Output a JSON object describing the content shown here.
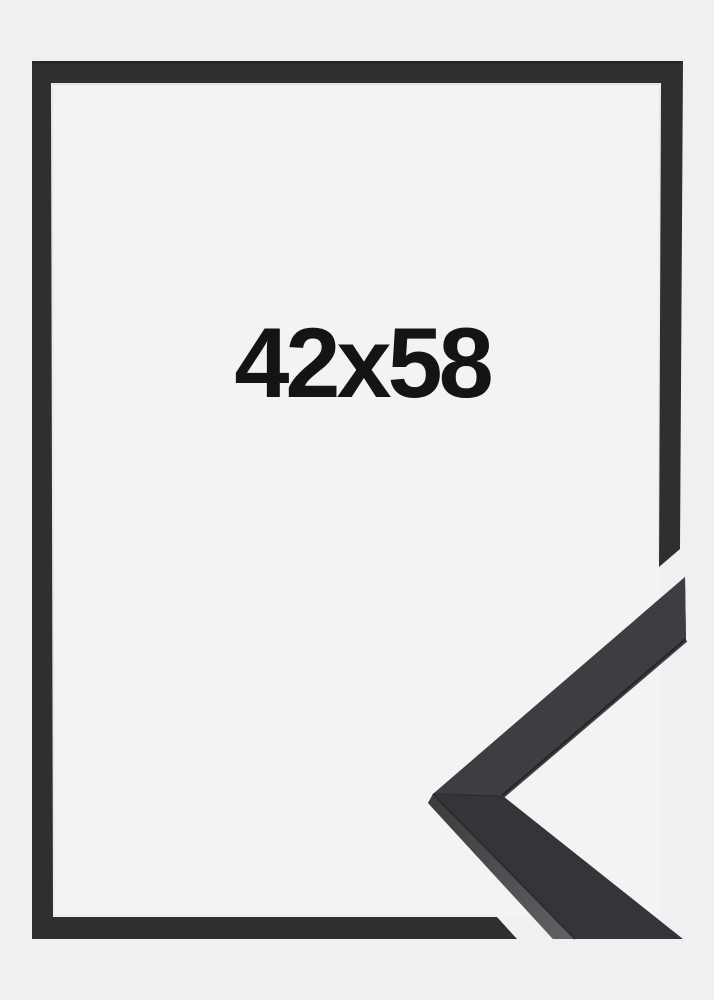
{
  "product": {
    "size_label": "42x58"
  },
  "colors": {
    "background": "#eff0f1",
    "frame_interior": "#f3f3f4",
    "frame": "#2e2f31",
    "frame_edge_dark": "#1e1f21",
    "frame_edge_light": "#c9cacb",
    "corner_front": "#343539",
    "corner_upper": "#3d3e41",
    "corner_side_near": "#3b3c3e",
    "corner_side_far": "#5e5f61",
    "corner_lip": "#202124",
    "corner_arris": "#28292b",
    "corner_seam": "#222325",
    "label_text": "#141414"
  }
}
